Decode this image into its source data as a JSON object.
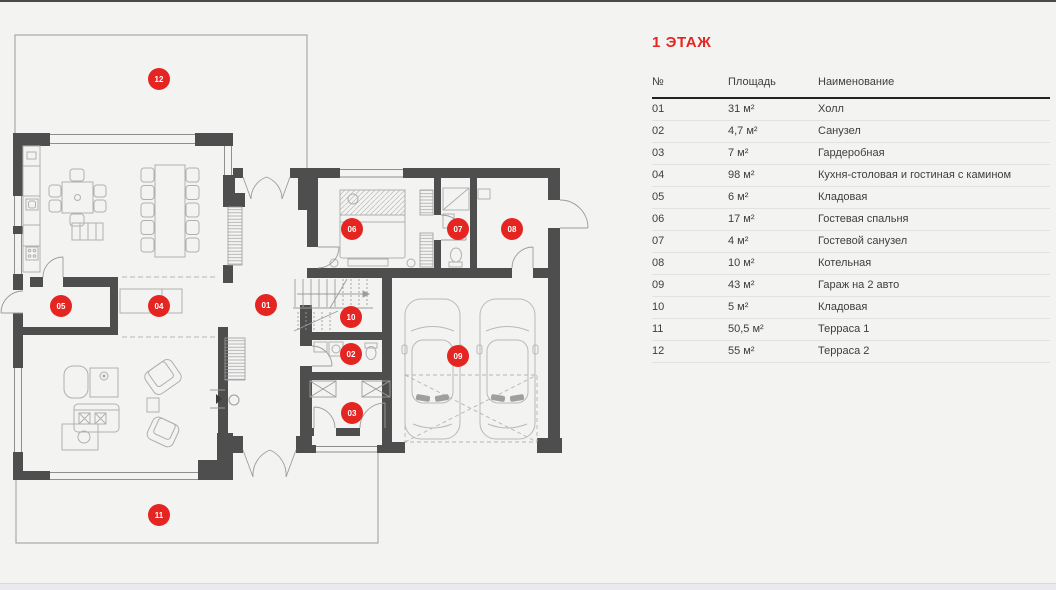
{
  "page": {
    "accent": "#e42522",
    "background": "#f3f3f2"
  },
  "legend": {
    "title": "1 ЭТАЖ",
    "columns": [
      "№",
      "Площадь",
      "Наименование"
    ],
    "rows": [
      {
        "num": "01",
        "area": "31 м²",
        "name": "Холл"
      },
      {
        "num": "02",
        "area": "4,7 м²",
        "name": "Санузел"
      },
      {
        "num": "03",
        "area": "7 м²",
        "name": "Гардеробная"
      },
      {
        "num": "04",
        "area": "98 м²",
        "name": "Кухня-столовая и гостиная с камином"
      },
      {
        "num": "05",
        "area": "6 м²",
        "name": "Кладовая"
      },
      {
        "num": "06",
        "area": "17 м²",
        "name": "Гостевая спальня"
      },
      {
        "num": "07",
        "area": "4 м²",
        "name": "Гостевой санузел"
      },
      {
        "num": "08",
        "area": "10 м²",
        "name": "Котельная"
      },
      {
        "num": "09",
        "area": "43 м²",
        "name": "Гараж на 2 авто"
      },
      {
        "num": "10",
        "area": "5 м²",
        "name": "Кладовая"
      },
      {
        "num": "11",
        "area": "50,5 м²",
        "name": "Терраса 1"
      },
      {
        "num": "12",
        "area": "55 м²",
        "name": "Терраса 2"
      }
    ]
  },
  "floor_plan": {
    "markers": [
      {
        "label": "01",
        "x": 266,
        "y": 305
      },
      {
        "label": "02",
        "x": 351,
        "y": 354
      },
      {
        "label": "03",
        "x": 352,
        "y": 413
      },
      {
        "label": "04",
        "x": 159,
        "y": 306
      },
      {
        "label": "05",
        "x": 61,
        "y": 306
      },
      {
        "label": "06",
        "x": 352,
        "y": 229
      },
      {
        "label": "07",
        "x": 458,
        "y": 229
      },
      {
        "label": "08",
        "x": 512,
        "y": 229
      },
      {
        "label": "09",
        "x": 458,
        "y": 356
      },
      {
        "label": "10",
        "x": 351,
        "y": 317
      },
      {
        "label": "11",
        "x": 159,
        "y": 515
      },
      {
        "label": "12",
        "x": 159,
        "y": 79
      }
    ]
  }
}
